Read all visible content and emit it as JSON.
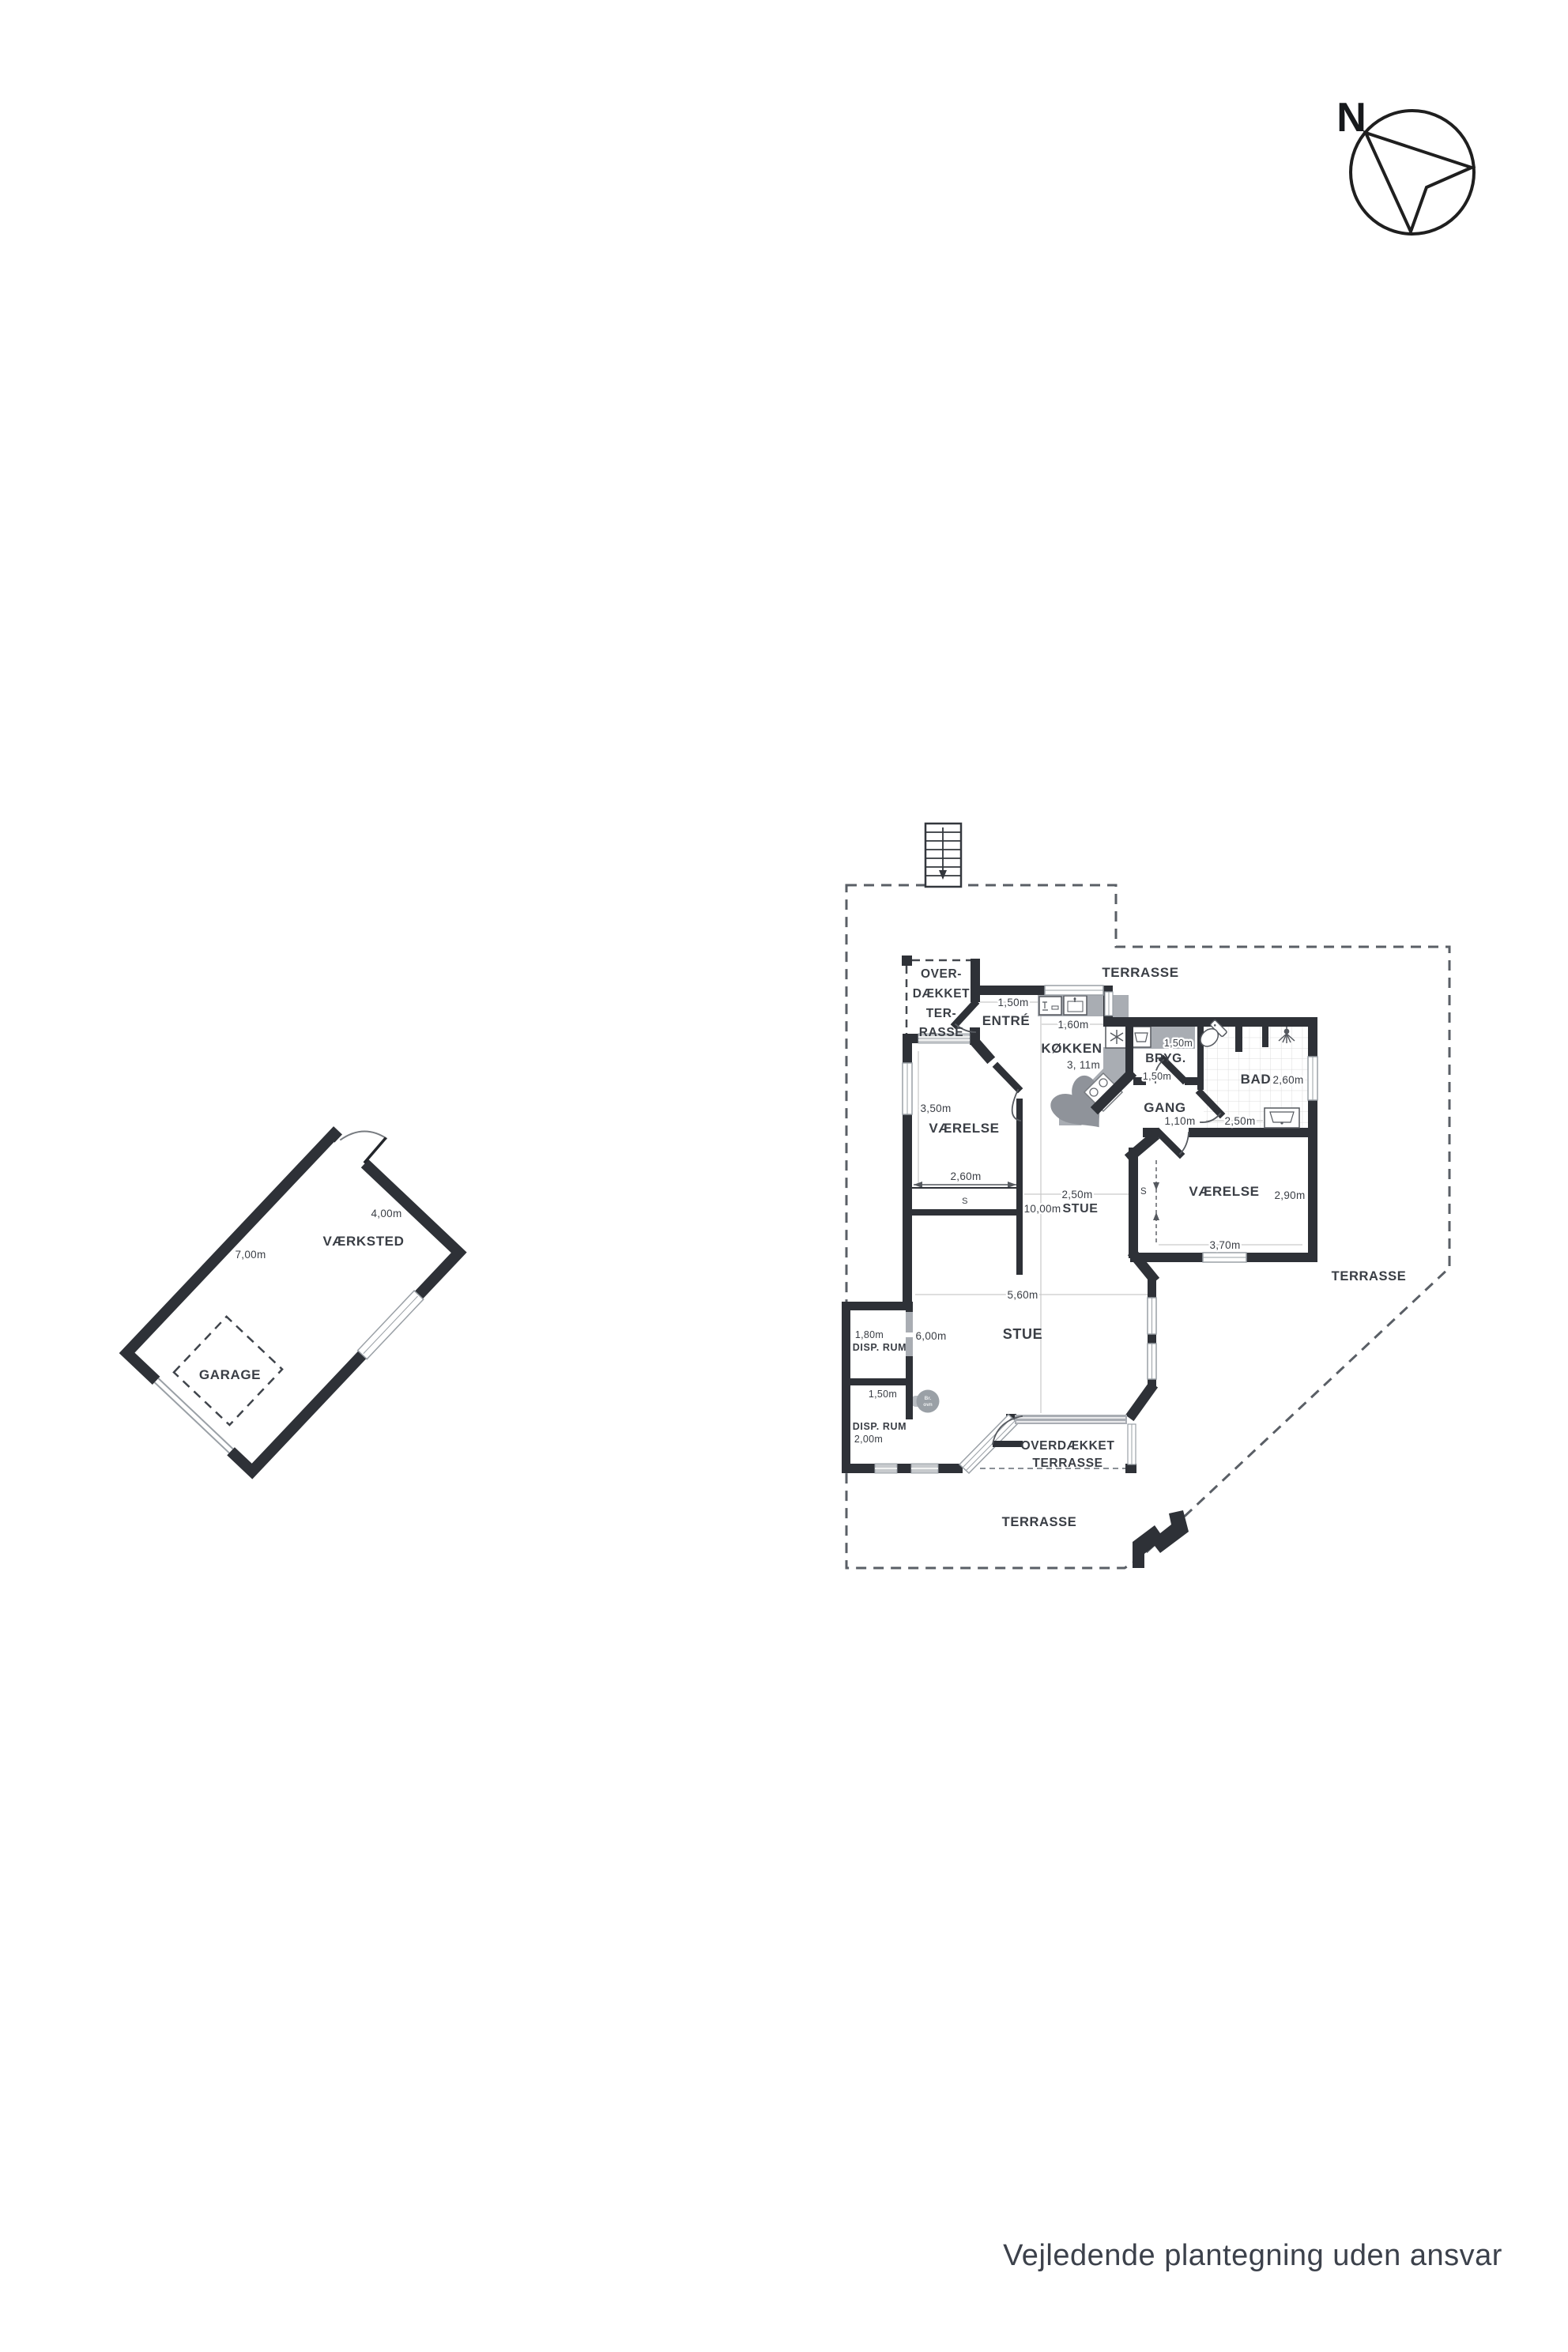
{
  "colors": {
    "wall": "#2e3137",
    "window_frame": "#9aa0a6",
    "counter": "#a9adb3",
    "island": "#8f939a",
    "boundary": "#5a5f66",
    "text": "#3a3e45",
    "tile_line": "#dcdcdc",
    "dim_line": "#c9c9c9"
  },
  "footer": "Vejledende plantegning uden ansvar",
  "compass": {
    "label": "N"
  },
  "outbuilding": {
    "workshop": "VÆRKSTED",
    "garage": "GARAGE",
    "dim_short": "4,00m",
    "dim_long": "7,00m"
  },
  "site": {
    "terrace_top": "TERRASSE",
    "terrace_right": "TERRASSE",
    "terrace_bottom": "TERRASSE",
    "covered_nw": [
      "OVER-",
      "DÆKKET",
      "TER-",
      "RASSE"
    ],
    "covered_s": [
      "OVERDÆKKET",
      "TERRASSE"
    ]
  },
  "rooms": {
    "entre": {
      "label": "ENTRÉ",
      "dim": "1,50m"
    },
    "koekken": {
      "label": "KØKKEN",
      "dim_depth": "3, 11m",
      "dim_counter": "1,60m"
    },
    "bryg": {
      "label": "BRYG.",
      "dim_w": "1,50m",
      "dim_h": "1,50m"
    },
    "bad": {
      "label": "BAD",
      "dim_h": "2,60m",
      "dim_w": "2,50m"
    },
    "gang": {
      "label": "GANG",
      "dim": "1,10m"
    },
    "vaerelse_w": {
      "label": "VÆRELSE",
      "dim_h": "3,50m",
      "dim_w": "2,60m",
      "closet": "S"
    },
    "vaerelse_e": {
      "label": "VÆRELSE",
      "dim_h": "2,90m",
      "dim_w": "3,70m",
      "closet": "S"
    },
    "stue": {
      "label": "STUE",
      "label_upper": "STUE",
      "dim_total": "10,00m",
      "dim_upper": "2,50m",
      "dim_lower": "5,60m",
      "dim_left": "6,00m"
    },
    "disp1": {
      "label": "DISP. RUM",
      "dim": "1,80m"
    },
    "disp2": {
      "label": "DISP. RUM",
      "dim_w": "1,50m",
      "dim_h": "2,00m"
    },
    "woodstove": {
      "line1": "Br.",
      "line2": "ovn"
    }
  }
}
